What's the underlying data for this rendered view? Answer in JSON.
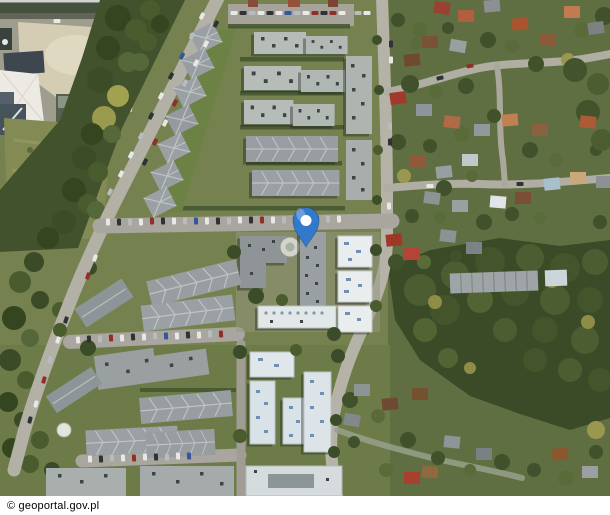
{
  "attribution": {
    "text": "© geoportal.gov.pl",
    "background": "#ffffff",
    "text_color": "#000000"
  },
  "marker": {
    "label": "location-pin",
    "color": "#3279cb",
    "hole_color": "#ffffff",
    "tip_x": 306,
    "tip_y": 247
  },
  "map": {
    "kind": "aerial-imagery",
    "width": 610,
    "height": 496,
    "palette": {
      "grass": "#75824f",
      "trees_dark": "#3b4b27",
      "trees_mid": "#55683a",
      "trees_autumn": "#a2a150",
      "road": "#b3b1a6",
      "sand": "#d4cdb4",
      "roof_gray": "#9aa0a3",
      "roof_flat_light": "#b6bcb8",
      "roof_white": "#e9edee",
      "roof_pale_blue": "#dce4e8",
      "house_red": "#a03a2c",
      "house_terracotta": "#b5604a"
    }
  }
}
